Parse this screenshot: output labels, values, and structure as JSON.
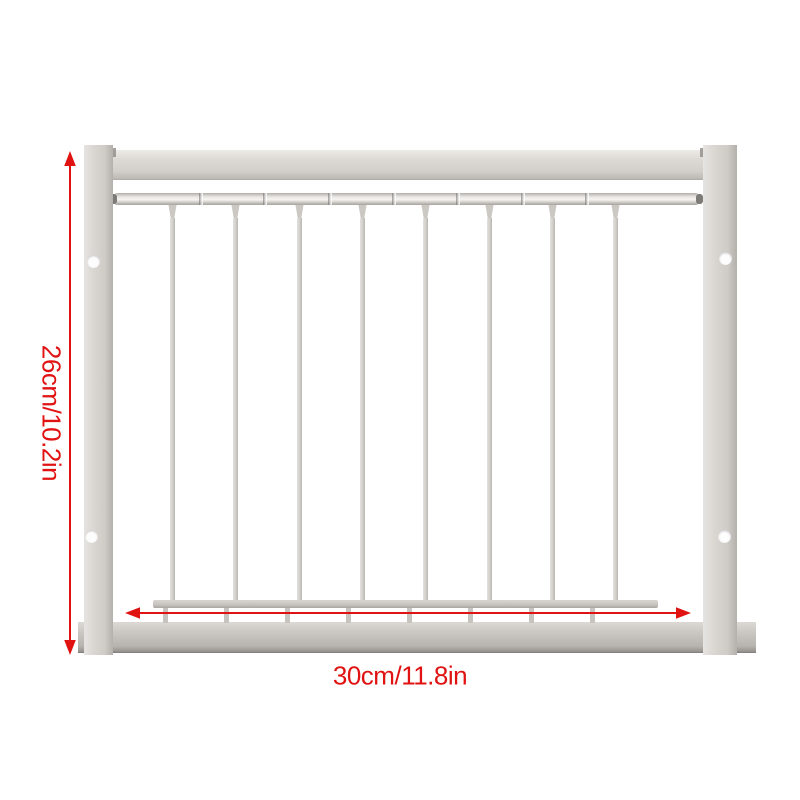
{
  "annotations": {
    "height_label": "26cm/10.2in",
    "width_label": "30cm/11.8in"
  },
  "colors": {
    "annotation_red": "#e01312",
    "metal_base": "#d4d1cc",
    "metal_highlight": "#efedea",
    "metal_shadow": "#a8a5a0",
    "background": "#ffffff"
  },
  "gate": {
    "vertical_bar_count": 8,
    "slide_rail_joint_count": 7,
    "screw_holes_per_post": 2
  }
}
